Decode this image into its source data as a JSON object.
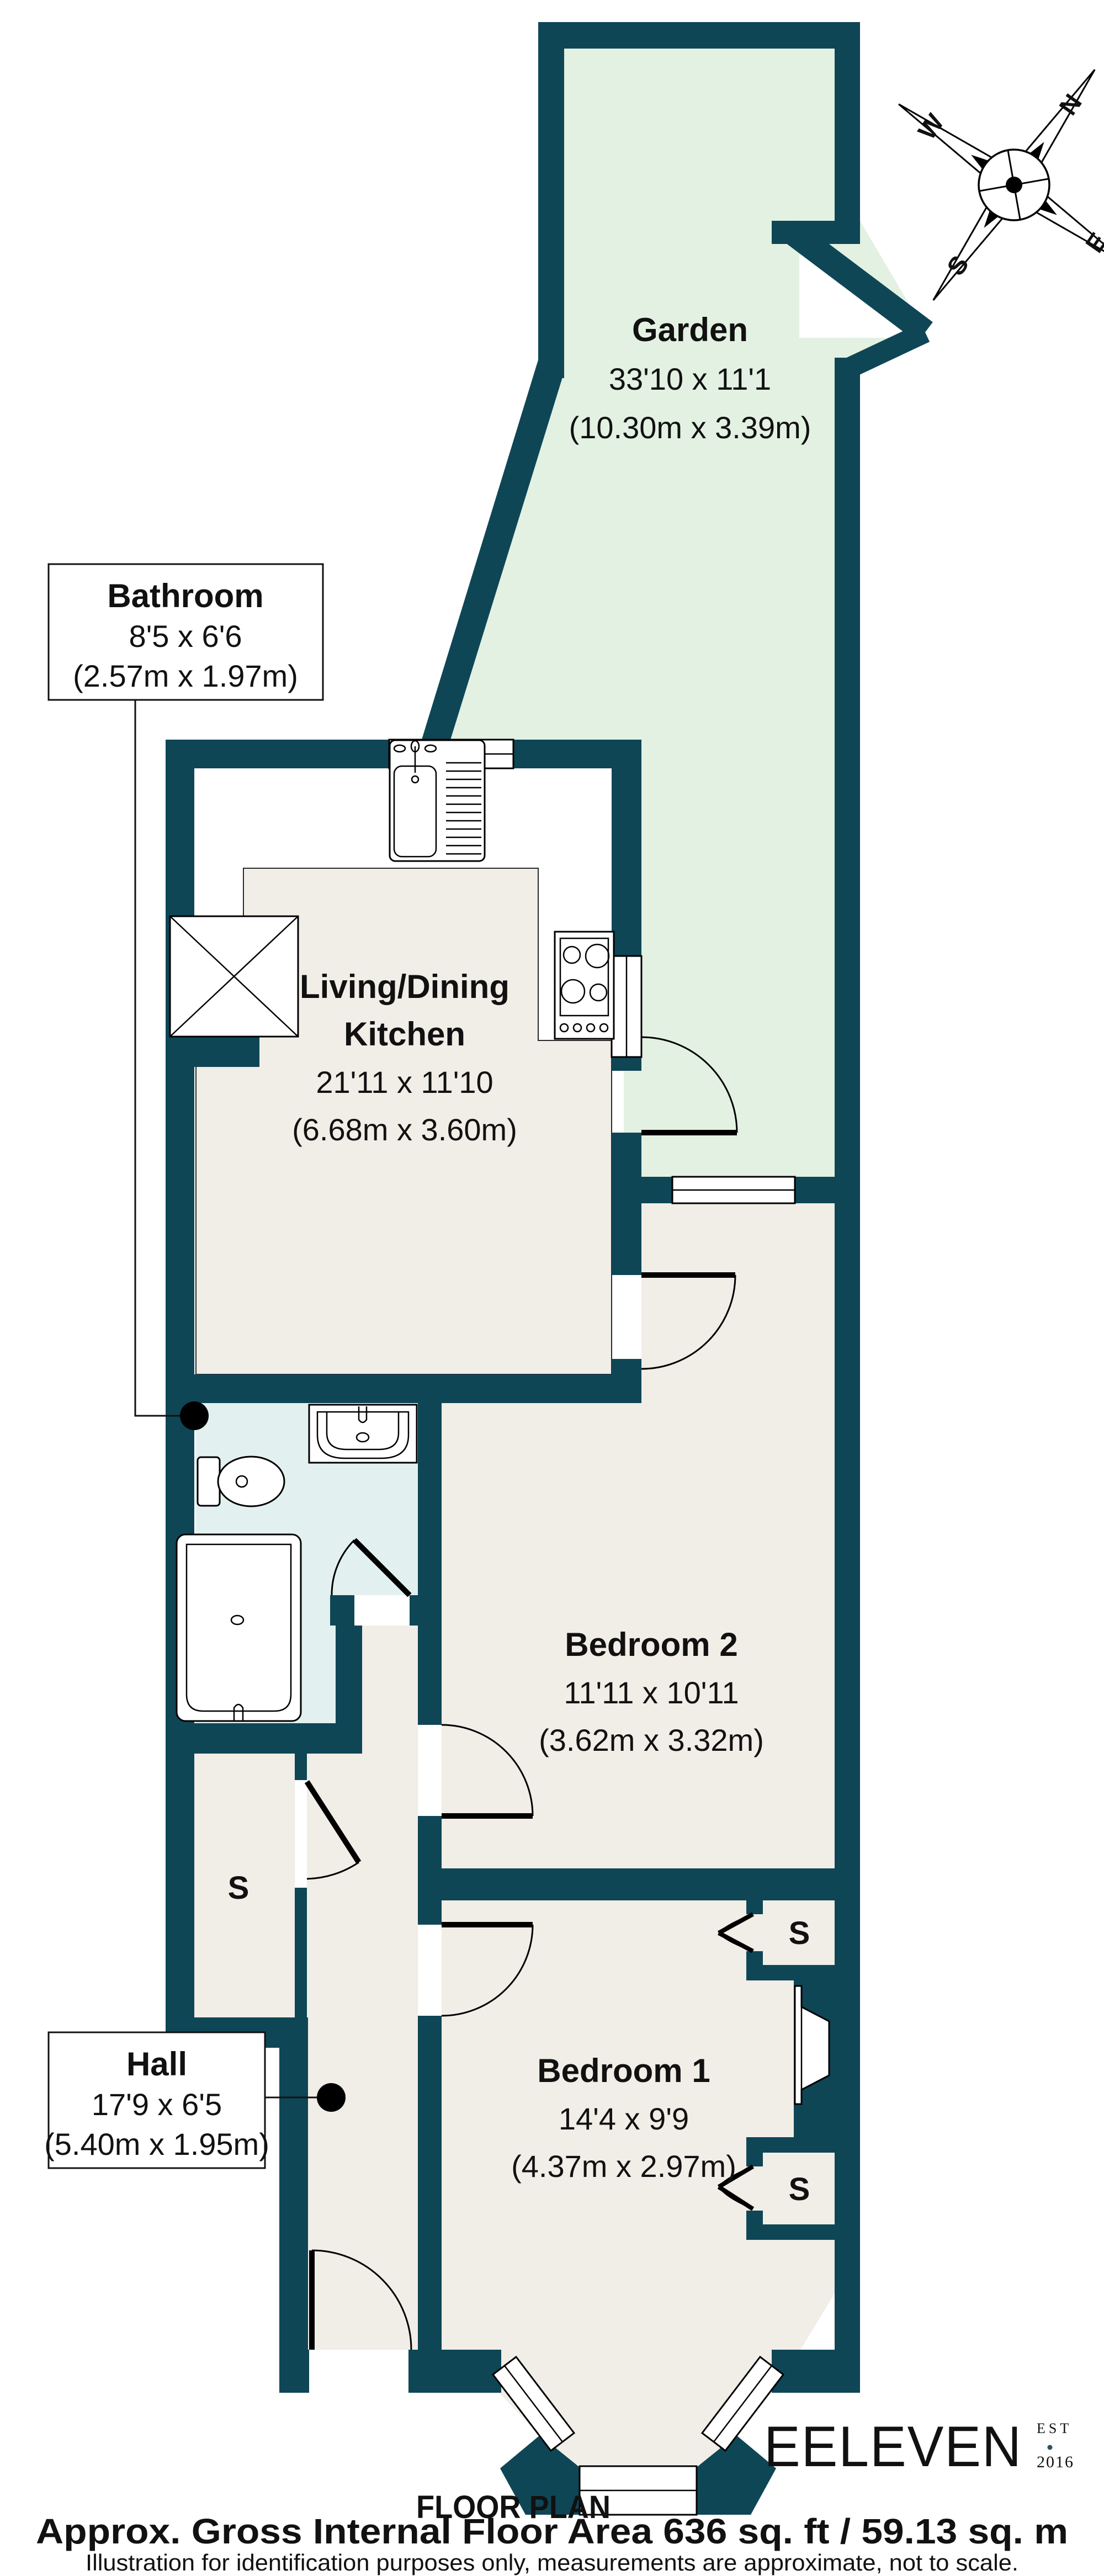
{
  "colors": {
    "wall": "#0e4656",
    "garden": "#e3f1e2",
    "floor": "#f1ede7",
    "bathroom_floor": "#e2f1f0",
    "logo": "#2c5365",
    "outline": "#000000"
  },
  "rooms": [
    {
      "name": "Garden",
      "dims_imperial": "33'10 x 11'1",
      "dims_metric": "(10.30m x 3.39m)"
    },
    {
      "name": "Living/Dining",
      "name_line2": "Kitchen",
      "dims_imperial": "21'11 x 11'10",
      "dims_metric": "(6.68m x 3.60m)"
    },
    {
      "name": "Bathroom",
      "dims_imperial": "8'5 x 6'6",
      "dims_metric": "(2.57m x 1.97m)"
    },
    {
      "name": "Bedroom 2",
      "dims_imperial": "11'11 x 10'11",
      "dims_metric": "(3.62m x 3.32m)"
    },
    {
      "name": "Hall",
      "dims_imperial": "17'9 x 6'5",
      "dims_metric": "(5.40m x 1.95m)"
    },
    {
      "name": "Bedroom 1",
      "dims_imperial": "14'4 x 9'9",
      "dims_metric": "(4.37m x 2.97m)"
    }
  ],
  "storage_label": "S",
  "compass": {
    "n": "N",
    "e": "E",
    "s": "S",
    "w": "W"
  },
  "page": {
    "floor_plan_title": "FLOOR PLAN",
    "footer_bold": "Approx. Gross Internal Floor Area 636 sq. ft / 59.13 sq. m",
    "footer_note": "Illustration for identification purposes only, measurements are approximate, not to scale."
  },
  "logo": {
    "name": "EELEVEN",
    "est": "EST",
    "year": "2016"
  }
}
